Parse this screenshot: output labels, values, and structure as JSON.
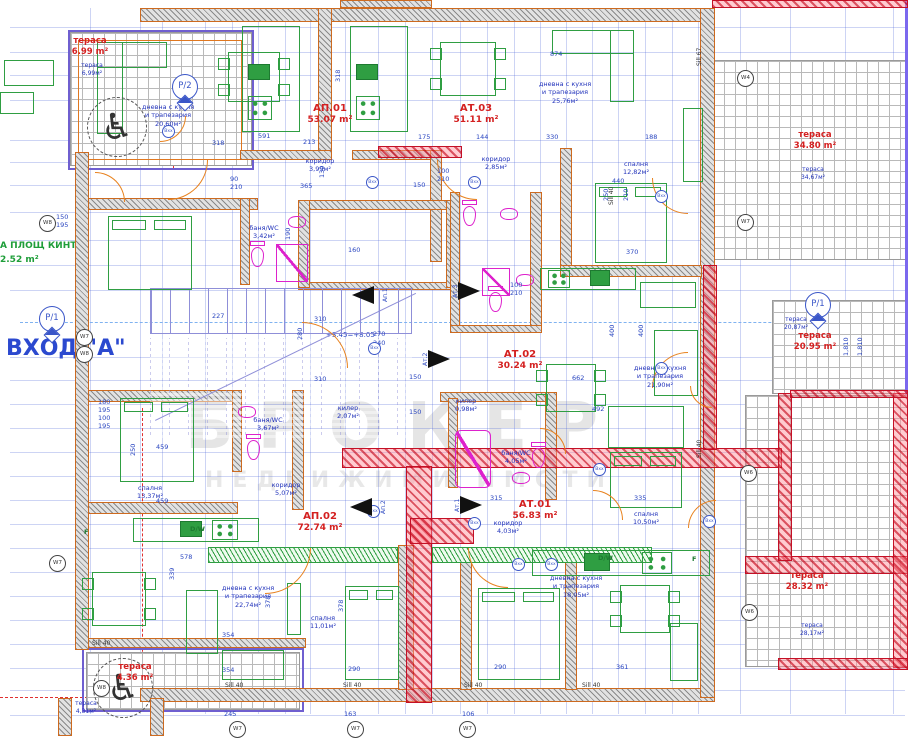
{
  "plan": {
    "entrance": "ВХОД \"А\"",
    "area_note_line1": "А ПЛОЩ КИНТ",
    "area_note_line2": "2.52 m²",
    "level_mark": "+3.45=+8.05",
    "watermark_line1": "БРОКЕР",
    "watermark_line2": "НЕДВИЖИМИ ИМОТИ"
  },
  "colors": {
    "dimension_blue": "#2a46c0",
    "label_red": "#d42020",
    "room_blue": "#2233bb",
    "wall_orange": "#cd6a1f",
    "furniture_green": "#2f9e42",
    "plumbing_magenta": "#dd22cc",
    "axis_blue": "#7fb2f0",
    "highlight_red": "#e03040"
  },
  "apartments": [
    {
      "id": "АП.01",
      "area": "53.07 m²",
      "x": 300,
      "y": 103
    },
    {
      "id": "АТ.03",
      "area": "51.11 m²",
      "x": 446,
      "y": 103
    },
    {
      "id": "АТ.02",
      "area": "30.24 m²",
      "x": 490,
      "y": 349
    },
    {
      "id": "АП.02",
      "area": "72.74 m²",
      "x": 290,
      "y": 511
    },
    {
      "id": "АТ.01",
      "area": "56.83 m²",
      "x": 505,
      "y": 499
    }
  ],
  "terraces": [
    {
      "name": "тераса",
      "area": "6.99 m²",
      "sub_area": "6,99м²",
      "rx": 60,
      "ry": 36,
      "bx": 62,
      "by": 62
    },
    {
      "name": "тераса",
      "area": "34.80 m²",
      "sub_area": "34,67м²",
      "rx": 785,
      "ry": 130,
      "bx": 783,
      "by": 166
    },
    {
      "name": "тераса",
      "area": "20.95 m²",
      "sub_area": "20,87м²",
      "rx": 785,
      "ry": 331,
      "bx": 766,
      "by": 316
    },
    {
      "name": "тераса",
      "area": "28.32 m²",
      "sub_area": "28,17м²",
      "rx": 777,
      "ry": 571,
      "bx": 782,
      "by": 622
    },
    {
      "name": "тераса",
      "area": "4.36 m²",
      "sub_area": "4,31м²",
      "rx": 105,
      "ry": 662,
      "bx": 56,
      "by": 700
    }
  ],
  "rooms": [
    {
      "lines": [
        "дневна с кухня",
        "и трапезария",
        "20,60м²"
      ],
      "x": 120,
      "y": 103,
      "w": 96
    },
    {
      "lines": [
        "дневна с кухня",
        "и трапезария",
        "25,76м²"
      ],
      "x": 515,
      "y": 80,
      "w": 100
    },
    {
      "lines": [
        "дневна с кухня",
        "и трапезария",
        "21,90м²"
      ],
      "x": 612,
      "y": 364,
      "w": 96
    },
    {
      "lines": [
        "дневна с кухня",
        "и трапезария",
        "22,74м²"
      ],
      "x": 200,
      "y": 584,
      "w": 96
    },
    {
      "lines": [
        "дневна с кухня",
        "и трапезария",
        "18,05м²"
      ],
      "x": 528,
      "y": 574,
      "w": 96
    },
    {
      "lines": [
        "спалня",
        "12,82м²"
      ],
      "x": 608,
      "y": 160,
      "w": 56
    },
    {
      "lines": [
        "спалня",
        "13,37м²"
      ],
      "x": 122,
      "y": 484,
      "w": 56
    },
    {
      "lines": [
        "спалня",
        "11,01м²"
      ],
      "x": 295,
      "y": 614,
      "w": 56
    },
    {
      "lines": [
        "спалня",
        "10,50м²"
      ],
      "x": 618,
      "y": 510,
      "w": 56
    },
    {
      "lines": [
        "коридор",
        "3,99м²"
      ],
      "x": 294,
      "y": 157,
      "w": 52
    },
    {
      "lines": [
        "коридор",
        "2,85м²"
      ],
      "x": 470,
      "y": 155,
      "w": 52
    },
    {
      "lines": [
        "коридор",
        "5,07м²"
      ],
      "x": 260,
      "y": 481,
      "w": 52
    },
    {
      "lines": [
        "коридор",
        "4,03м²"
      ],
      "x": 482,
      "y": 519,
      "w": 52
    },
    {
      "lines": [
        "баня/WC",
        "3,42м²"
      ],
      "x": 240,
      "y": 224,
      "w": 48
    },
    {
      "lines": [
        "баня/WC",
        "3,67м²"
      ],
      "x": 244,
      "y": 416,
      "w": 48
    },
    {
      "lines": [
        "баня/WC",
        "4,05м²"
      ],
      "x": 492,
      "y": 449,
      "w": 48
    },
    {
      "lines": [
        "килер",
        "2,07м²"
      ],
      "x": 326,
      "y": 404,
      "w": 44
    },
    {
      "lines": [
        "килер",
        "0,98м²"
      ],
      "x": 444,
      "y": 397,
      "w": 44
    }
  ],
  "axis_markers": [
    {
      "label": "Р/2",
      "x": 172,
      "y": 74
    },
    {
      "label": "Р/1",
      "x": 39,
      "y": 306
    },
    {
      "label": "Р/1",
      "x": 805,
      "y": 292
    }
  ],
  "window_markers": [
    {
      "label": "W8",
      "x": 39,
      "y": 215
    },
    {
      "label": "W7",
      "x": 76,
      "y": 329
    },
    {
      "label": "W8",
      "x": 76,
      "y": 346
    },
    {
      "label": "W7",
      "x": 49,
      "y": 555
    },
    {
      "label": "W8",
      "x": 93,
      "y": 680
    },
    {
      "label": "W4",
      "x": 737,
      "y": 70
    },
    {
      "label": "W7",
      "x": 737,
      "y": 214
    },
    {
      "label": "W6",
      "x": 740,
      "y": 465
    },
    {
      "label": "W6",
      "x": 741,
      "y": 604
    },
    {
      "label": "W7",
      "x": 229,
      "y": 721
    },
    {
      "label": "W7",
      "x": 347,
      "y": 721
    },
    {
      "label": "W7",
      "x": 459,
      "y": 721
    }
  ],
  "door_tags": {
    "label": "Вхх",
    "points": [
      [
        366,
        176
      ],
      [
        468,
        176
      ],
      [
        368,
        342
      ],
      [
        367,
        505
      ],
      [
        468,
        517
      ],
      [
        162,
        125
      ],
      [
        593,
        463
      ],
      [
        512,
        558
      ],
      [
        655,
        190
      ],
      [
        655,
        362
      ],
      [
        545,
        558
      ],
      [
        703,
        515
      ]
    ]
  },
  "kitchen_labels": [
    {
      "t": "F",
      "x": 84,
      "y": 528
    },
    {
      "t": "D/W",
      "x": 190,
      "y": 525
    },
    {
      "t": "D/W",
      "x": 598,
      "y": 554
    },
    {
      "t": "F",
      "x": 692,
      "y": 555
    }
  ],
  "sill_labels": [
    {
      "t": "Sill 40",
      "x": 225,
      "y": 682
    },
    {
      "t": "Sill 40",
      "x": 343,
      "y": 682
    },
    {
      "t": "Sill 40",
      "x": 464,
      "y": 682
    },
    {
      "t": "Sill 40",
      "x": 582,
      "y": 682
    },
    {
      "t": "Sill 40",
      "x": 92,
      "y": 640
    },
    {
      "t": "Sill 40",
      "x": 608,
      "y": 205,
      "v": true
    },
    {
      "t": "Sill 40",
      "x": 696,
      "y": 458,
      "v": true
    },
    {
      "t": "Sill 67",
      "x": 696,
      "y": 66,
      "v": true
    }
  ],
  "section_arrows": [
    {
      "label": "Ап.1",
      "x": 352,
      "y": 286,
      "dir": "left"
    },
    {
      "label": "Ат.3",
      "x": 458,
      "y": 282,
      "dir": "right"
    },
    {
      "label": "Ат.2",
      "x": 428,
      "y": 350,
      "dir": "right"
    },
    {
      "label": "Ап.2",
      "x": 350,
      "y": 498,
      "dir": "left"
    },
    {
      "label": "Ат.1",
      "x": 460,
      "y": 496,
      "dir": "right"
    }
  ],
  "dims": [
    {
      "t": "874",
      "x": 550,
      "y": 50
    },
    {
      "t": "330",
      "x": 546,
      "y": 133
    },
    {
      "t": "318",
      "x": 212,
      "y": 139
    },
    {
      "t": "591",
      "x": 258,
      "y": 132
    },
    {
      "t": "213",
      "x": 303,
      "y": 138
    },
    {
      "t": "175",
      "x": 418,
      "y": 133
    },
    {
      "t": "144",
      "x": 476,
      "y": 133
    },
    {
      "t": "188",
      "x": 645,
      "y": 133
    },
    {
      "t": "365",
      "x": 300,
      "y": 182
    },
    {
      "t": "150",
      "x": 413,
      "y": 181
    },
    {
      "t": "130",
      "x": 318,
      "y": 178,
      "v": true
    },
    {
      "t": "318",
      "x": 334,
      "y": 82,
      "v": true
    },
    {
      "t": "227",
      "x": 212,
      "y": 312
    },
    {
      "t": "310",
      "x": 314,
      "y": 315
    },
    {
      "t": "310",
      "x": 314,
      "y": 375
    },
    {
      "t": "280",
      "x": 296,
      "y": 340,
      "v": true
    },
    {
      "t": "150",
      "x": 409,
      "y": 373
    },
    {
      "t": "150",
      "x": 409,
      "y": 408
    },
    {
      "t": "270",
      "x": 373,
      "y": 330
    },
    {
      "t": "240",
      "x": 373,
      "y": 339
    },
    {
      "t": "100",
      "x": 437,
      "y": 167
    },
    {
      "t": "210",
      "x": 437,
      "y": 175
    },
    {
      "t": "100",
      "x": 510,
      "y": 281
    },
    {
      "t": "210",
      "x": 510,
      "y": 289
    },
    {
      "t": "160",
      "x": 348,
      "y": 246
    },
    {
      "t": "190",
      "x": 284,
      "y": 240,
      "v": true
    },
    {
      "t": "90",
      "x": 230,
      "y": 175
    },
    {
      "t": "210",
      "x": 230,
      "y": 183
    },
    {
      "t": "459",
      "x": 156,
      "y": 443
    },
    {
      "t": "459",
      "x": 156,
      "y": 497
    },
    {
      "t": "250",
      "x": 129,
      "y": 456,
      "v": true
    },
    {
      "t": "354",
      "x": 222,
      "y": 631
    },
    {
      "t": "354",
      "x": 222,
      "y": 666
    },
    {
      "t": "578",
      "x": 180,
      "y": 553
    },
    {
      "t": "339",
      "x": 168,
      "y": 580,
      "v": true
    },
    {
      "t": "378",
      "x": 264,
      "y": 608,
      "v": true
    },
    {
      "t": "378",
      "x": 337,
      "y": 612,
      "v": true
    },
    {
      "t": "290",
      "x": 348,
      "y": 665
    },
    {
      "t": "290",
      "x": 494,
      "y": 663
    },
    {
      "t": "361",
      "x": 616,
      "y": 663
    },
    {
      "t": "335",
      "x": 634,
      "y": 494
    },
    {
      "t": "492",
      "x": 592,
      "y": 405
    },
    {
      "t": "662",
      "x": 572,
      "y": 374
    },
    {
      "t": "400",
      "x": 608,
      "y": 337,
      "v": true
    },
    {
      "t": "400",
      "x": 637,
      "y": 337,
      "v": true
    },
    {
      "t": "440",
      "x": 612,
      "y": 177
    },
    {
      "t": "250",
      "x": 602,
      "y": 201,
      "v": true
    },
    {
      "t": "210",
      "x": 622,
      "y": 201,
      "v": true
    },
    {
      "t": "370",
      "x": 626,
      "y": 248
    },
    {
      "t": "315",
      "x": 490,
      "y": 494
    },
    {
      "t": "245",
      "x": 224,
      "y": 710
    },
    {
      "t": "163",
      "x": 344,
      "y": 710
    },
    {
      "t": "106",
      "x": 462,
      "y": 710
    },
    {
      "t": "1,810",
      "x": 842,
      "y": 356,
      "v": true
    },
    {
      "t": "1,810",
      "x": 856,
      "y": 356,
      "v": true
    },
    {
      "t": "150",
      "x": 56,
      "y": 213
    },
    {
      "t": "195",
      "x": 56,
      "y": 221
    },
    {
      "t": "180",
      "x": 98,
      "y": 398
    },
    {
      "t": "195",
      "x": 98,
      "y": 406
    },
    {
      "t": "100",
      "x": 98,
      "y": 414
    },
    {
      "t": "195",
      "x": 98,
      "y": 422
    }
  ]
}
